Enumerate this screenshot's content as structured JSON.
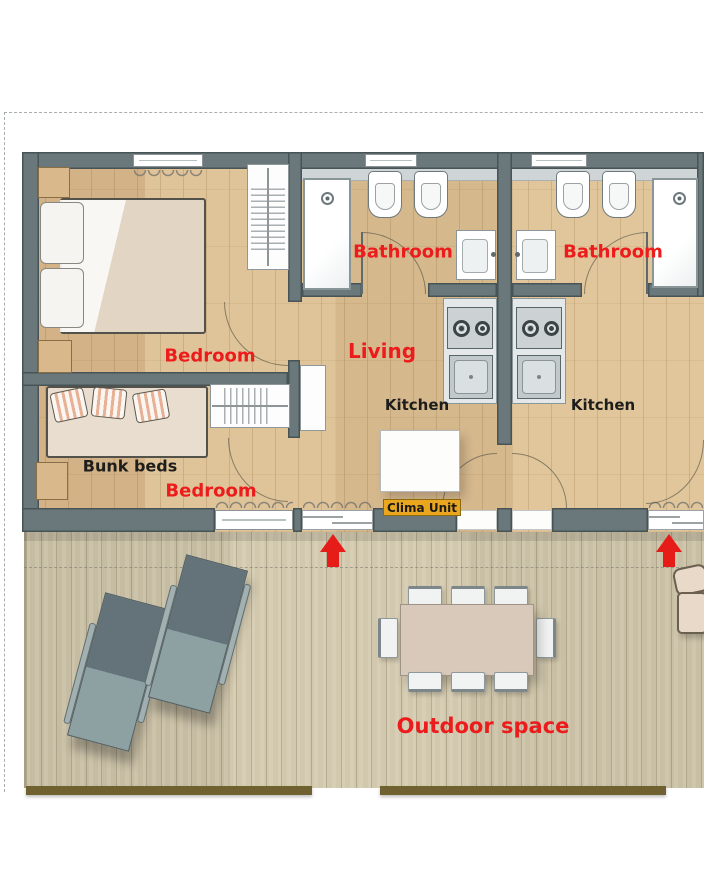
{
  "labels": {
    "bedroom_top": "Bedroom",
    "bedroom_bottom": "Bedroom",
    "bunk_beds": "Bunk beds",
    "bathroom_left": "Bathroom",
    "bathroom_right": "Bathroom",
    "living": "Living",
    "kitchen_left": "Kitchen",
    "kitchen_right": "Kitchen",
    "clima_unit": "Clima Unit",
    "outdoor_space": "Outdoor space"
  },
  "icons": {
    "entrance_arrow": "up-arrow"
  },
  "colors": {
    "room_label_red": "#ec1c1c",
    "room_label_black": "#1d1d1b",
    "wall_grey": "#6a787b",
    "clima_bg": "#e9a61e",
    "entrance_arrow_red": "#e51c18",
    "indoor_floor_wood": "#dcbe92",
    "outdoor_deck_wood": "#cdc3a8",
    "deck_edge_brown": "#6f6130"
  }
}
